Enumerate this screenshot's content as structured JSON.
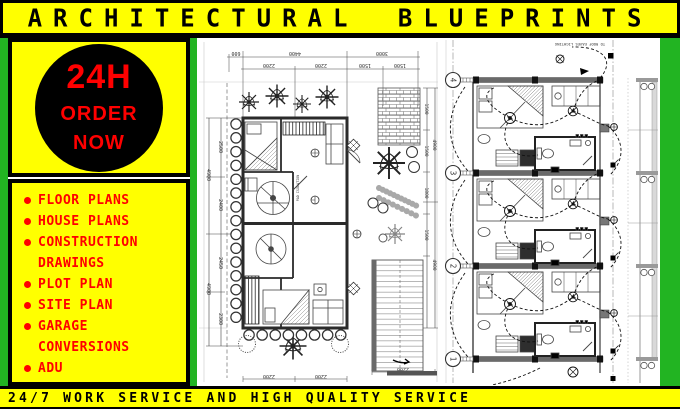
{
  "header": {
    "title": "ARCHITECTURAL BLUEPRINTS"
  },
  "sidebar": {
    "badge": {
      "hours": "24H",
      "order_line1": "ORDER",
      "order_line2": "NOW"
    },
    "services": [
      "FLOOR PLANS",
      "HOUSE PLANS",
      "CONSTRUCTION DRAWINGS",
      "PLOT PLAN",
      "SITE PLAN",
      "GARAGE CONVERSIONS",
      "ADU"
    ]
  },
  "footer": {
    "text": "24/7 WORK SERVICE AND HIGH QUALITY SERVICE"
  },
  "floor_plan": {
    "label_pad_isolation": "PAD ISOLATION",
    "dims_top_outer": [
      "600",
      "4400",
      "3000"
    ],
    "dims_top_inner": [
      "2200",
      "2200",
      "1500",
      "1500"
    ],
    "dims_left_outer": [
      "4900",
      "4900"
    ],
    "dims_left_inner": [
      "2500",
      "2400",
      "2450",
      "2300"
    ],
    "dims_right_inner": [
      "1500",
      "1500",
      "1800",
      "1500"
    ],
    "dims_right_outer": [
      "4900",
      "4900"
    ],
    "dims_bottom": [
      "2200",
      "2200",
      "2200"
    ]
  },
  "electrical_plan": {
    "note_roof": "TO ROOF EAVES LIGHTING",
    "grid_labels": [
      "4",
      "3",
      "2",
      "1"
    ]
  },
  "colors": {
    "yellow": "#FFFF00",
    "green": "#22B422",
    "red": "#FF0000",
    "black": "#000000",
    "wall_gray": "#666666"
  }
}
